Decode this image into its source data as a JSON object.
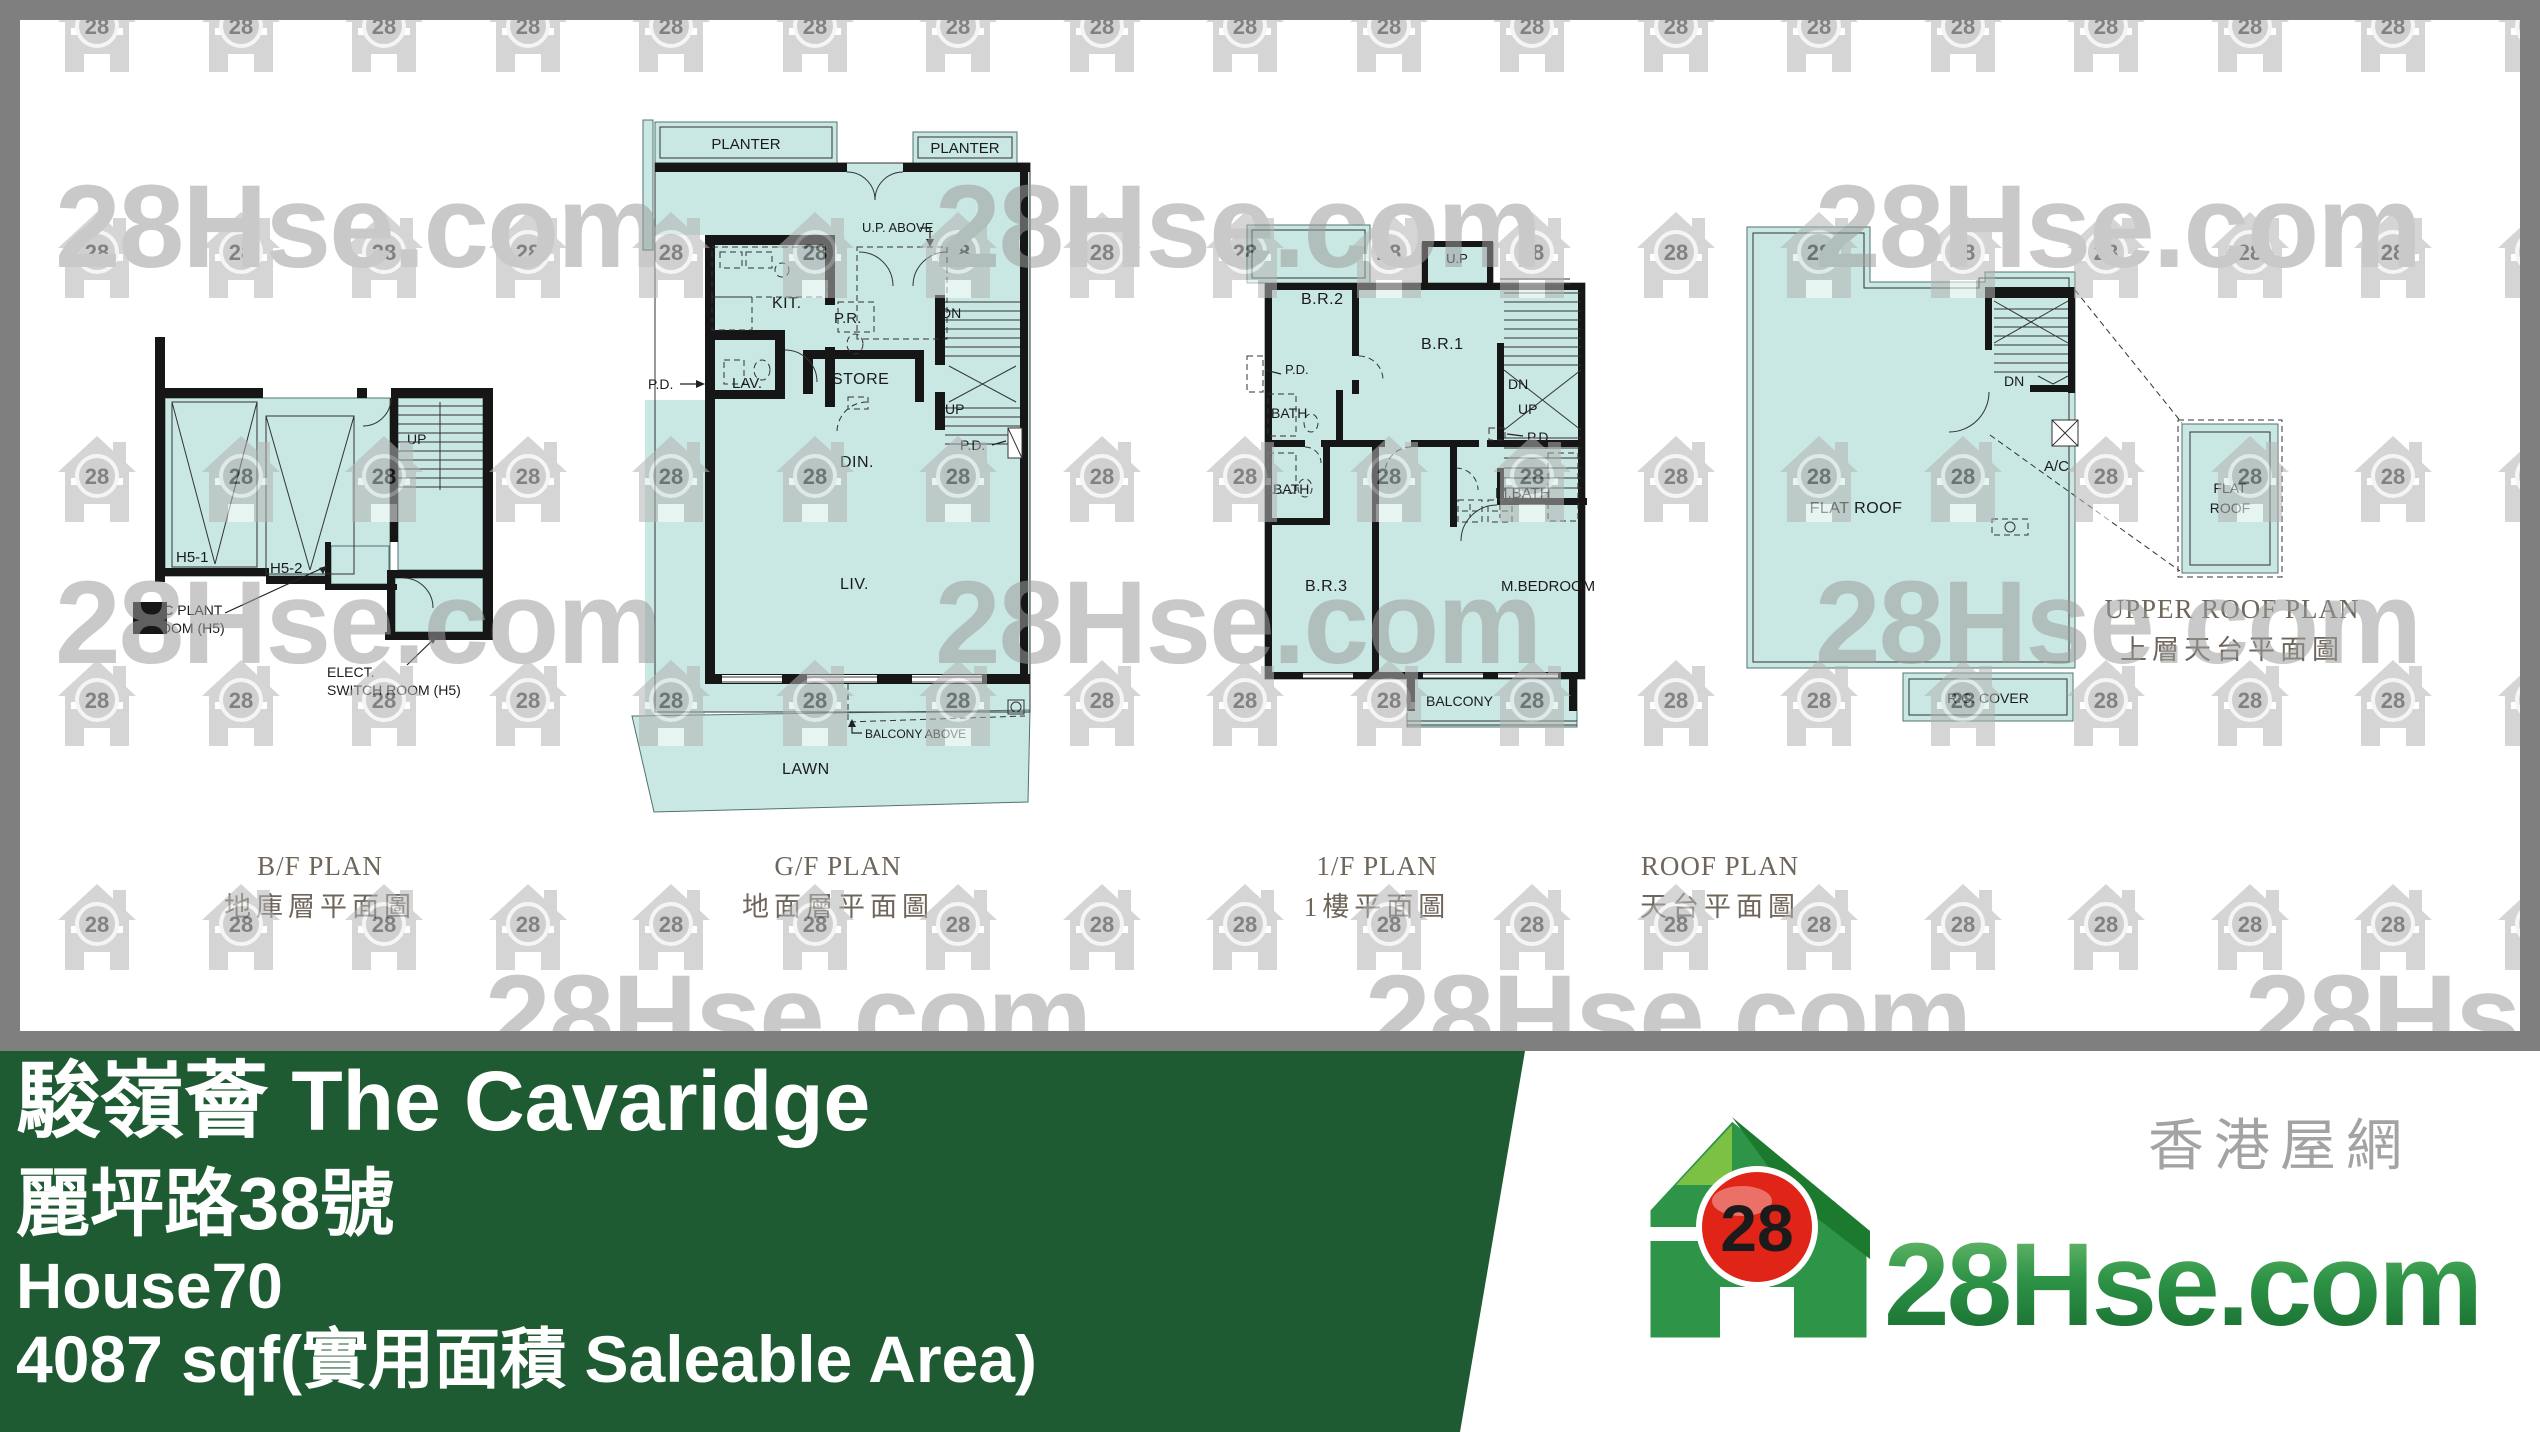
{
  "watermark": {
    "text": "28Hse.com",
    "badge": "28"
  },
  "colors": {
    "frame_gray": "#7f7f7f",
    "plan_teal": "#c9e7e3",
    "banner_green": "#1e5a32",
    "logo_green": "#2e9447",
    "logo_red": "#e02418",
    "title_brown": "#6f665b"
  },
  "plans": {
    "bf": {
      "title_en": "B/F PLAN",
      "title_zh": "地庫層平面圖",
      "labels": {
        "h51": "H5-1",
        "h52": "H5-2",
        "up": "UP",
        "ac1": "A/C PLANT",
        "ac2": "ROOM (H5)",
        "elect1": "ELECT.",
        "elect2": "SWITCH ROOM (H5)"
      }
    },
    "gf": {
      "title_en": "G/F PLAN",
      "title_zh": "地面層平面圖",
      "labels": {
        "planter": "PLANTER",
        "up_above": "U.P. ABOVE",
        "kit": "KIT.",
        "pr": "P.R.",
        "dn": "DN",
        "up": "UP",
        "store": "STORE",
        "lav": "LAV.",
        "pd": "P.D.",
        "din": "DIN.",
        "liv": "LIV.",
        "lawn": "LAWN",
        "balcony_above": "BALCONY ABOVE"
      }
    },
    "ff": {
      "title_en": "1/F PLAN",
      "title_zh": "1樓平面圖",
      "labels": {
        "up_box": "U.P",
        "br2": "B.R.2",
        "br1": "B.R.1",
        "pd": "P.D.",
        "bath": "BATH",
        "dn": "DN",
        "up": "UP",
        "mbath": "M.BATH",
        "br3": "B.R.3",
        "mbedroom": "M.BEDROOM",
        "balcony": "BALCONY"
      }
    },
    "roof": {
      "title_en": "ROOF PLAN",
      "title_zh": "天台平面圖",
      "labels": {
        "flat_roof": "FLAT ROOF",
        "dn": "DN",
        "ac": "A/C",
        "rc": "R.C. COVER"
      }
    },
    "upper": {
      "title_en": "UPPER ROOF PLAN",
      "title_zh": "上層天台平面圖",
      "labels": {
        "flat": "FLAT",
        "roof": "ROOF"
      }
    }
  },
  "banner": {
    "project": "駿嶺薈 The Cavaridge",
    "address": "麗坪路38號",
    "house": "House70",
    "area": "4087 sqf(實用面積 Saleable Area)"
  },
  "logo": {
    "site": "28Hse.com",
    "tagline": "香港屋網",
    "badge": "28"
  }
}
